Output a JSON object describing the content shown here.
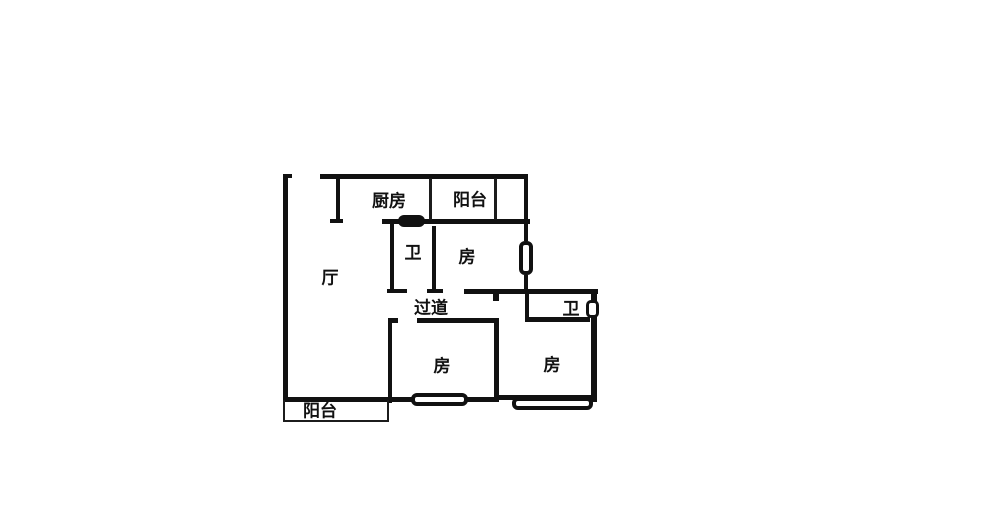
{
  "canvas": {
    "width": 1000,
    "height": 509,
    "background_color": "#ffffff",
    "line_color": "#111111"
  },
  "floorplan": {
    "type": "apartment-floor-plan",
    "rooms": [
      {
        "id": "kitchen",
        "label": "厨房",
        "cx": 389,
        "cy": 201
      },
      {
        "id": "balcony-top",
        "label": "阳台",
        "cx": 470,
        "cy": 200
      },
      {
        "id": "bath-1",
        "label": "卫",
        "cx": 413,
        "cy": 253
      },
      {
        "id": "bedroom-top",
        "label": "房",
        "cx": 467,
        "cy": 257
      },
      {
        "id": "living-room",
        "label": "厅",
        "cx": 330,
        "cy": 278
      },
      {
        "id": "corridor",
        "label": "过道",
        "cx": 431,
        "cy": 308
      },
      {
        "id": "bath-2",
        "label": "卫",
        "cx": 571,
        "cy": 309
      },
      {
        "id": "bedroom-mid",
        "label": "房",
        "cx": 442,
        "cy": 366
      },
      {
        "id": "bedroom-right",
        "label": "房",
        "cx": 552,
        "cy": 365
      },
      {
        "id": "balcony-bottom",
        "label": "阳台",
        "cx": 320,
        "cy": 411
      }
    ],
    "walls": [
      {
        "name": "outer-left-wall",
        "x": 283,
        "y": 174,
        "w": 5,
        "h": 227
      },
      {
        "name": "entry-left-cap",
        "x": 283,
        "y": 174,
        "w": 9,
        "h": 4
      },
      {
        "name": "outer-top-wall",
        "x": 320,
        "y": 174,
        "w": 208,
        "h": 5
      },
      {
        "name": "kitchen-left-wall",
        "x": 336,
        "y": 176,
        "w": 4,
        "h": 46
      },
      {
        "name": "kitchen-bottom-cap",
        "x": 330,
        "y": 219,
        "w": 13,
        "h": 4
      },
      {
        "name": "kitchen-balcony-bottom-wall",
        "x": 382,
        "y": 219,
        "w": 148,
        "h": 5
      },
      {
        "name": "bath1-left-wall",
        "x": 390,
        "y": 222,
        "w": 4,
        "h": 70
      },
      {
        "name": "bath1-right-wall",
        "x": 432,
        "y": 226,
        "w": 4,
        "h": 66
      },
      {
        "name": "corridor-top-wall-a",
        "x": 387,
        "y": 289,
        "w": 20,
        "h": 4
      },
      {
        "name": "corridor-top-wall-b",
        "x": 427,
        "y": 289,
        "w": 16,
        "h": 4
      },
      {
        "name": "corridor-top-wall-c",
        "x": 464,
        "y": 289,
        "w": 134,
        "h": 5
      },
      {
        "name": "door-jamb-stub",
        "x": 493,
        "y": 293,
        "w": 6,
        "h": 8
      },
      {
        "name": "upper-right-wall-top",
        "x": 524,
        "y": 176,
        "w": 4,
        "h": 65
      },
      {
        "name": "upper-right-wall-bottom",
        "x": 524,
        "y": 275,
        "w": 4,
        "h": 19
      },
      {
        "name": "bath2-left-wall",
        "x": 525,
        "y": 293,
        "w": 4,
        "h": 28
      },
      {
        "name": "bath2-bottom-wall",
        "x": 525,
        "y": 317,
        "w": 65,
        "h": 5
      },
      {
        "name": "outer-right-wall",
        "x": 591,
        "y": 289,
        "w": 6,
        "h": 113
      },
      {
        "name": "corridor-bottom-corner",
        "x": 388,
        "y": 318,
        "w": 10,
        "h": 5
      },
      {
        "name": "corridor-bottom-wall",
        "x": 417,
        "y": 318,
        "w": 82,
        "h": 5
      },
      {
        "name": "bedroom-mid-left-wall",
        "x": 388,
        "y": 318,
        "w": 4,
        "h": 85
      },
      {
        "name": "bedroom-shared-wall",
        "x": 494,
        "y": 318,
        "w": 5,
        "h": 84
      },
      {
        "name": "bottom-wall-left",
        "x": 283,
        "y": 397,
        "w": 216,
        "h": 5
      },
      {
        "name": "bottom-wall-right",
        "x": 499,
        "y": 395,
        "w": 98,
        "h": 5
      }
    ],
    "thin_lines": [
      {
        "name": "top-strip-divider-kitchen-balcony",
        "x": 429,
        "y": 178,
        "w": 3,
        "h": 42
      },
      {
        "name": "top-strip-divider-balcony-right",
        "x": 494,
        "y": 178,
        "w": 3,
        "h": 42
      },
      {
        "name": "balcony-outline-left",
        "x": 283,
        "y": 400,
        "w": 2,
        "h": 22
      },
      {
        "name": "balcony-outline-bottom",
        "x": 283,
        "y": 420,
        "w": 106,
        "h": 2
      },
      {
        "name": "balcony-outline-right",
        "x": 387,
        "y": 400,
        "w": 2,
        "h": 22
      }
    ],
    "windows": [
      {
        "name": "window-upper-right-wall",
        "x": 519,
        "y": 241,
        "w": 14,
        "h": 34,
        "border": 4,
        "radius": 6
      },
      {
        "name": "window-bath2-right-wall",
        "x": 586,
        "y": 300,
        "w": 13,
        "h": 18,
        "border": 3,
        "radius": 5
      },
      {
        "name": "window-bedroom-mid",
        "x": 411,
        "y": 393,
        "w": 57,
        "h": 13,
        "border": 4,
        "radius": 6
      },
      {
        "name": "window-bedroom-right",
        "x": 512,
        "y": 397,
        "w": 81,
        "h": 13,
        "border": 4,
        "radius": 6
      }
    ],
    "doors": [
      {
        "name": "kitchen-sliding-door-panel",
        "x": 398,
        "y": 215,
        "w": 27,
        "h": 12,
        "radius": 6
      }
    ]
  }
}
